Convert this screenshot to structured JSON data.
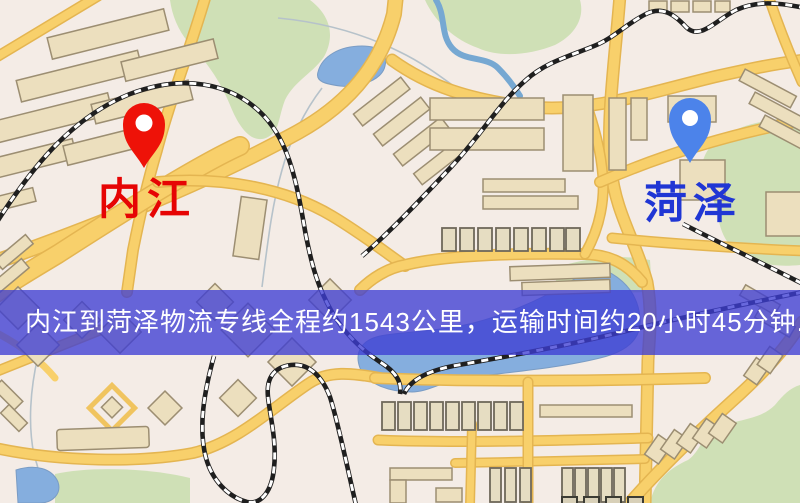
{
  "banner": {
    "text": "内江到菏泽物流专线全程约1543公里，运输时间约20小时45分钟.",
    "background": "#3e3ed4",
    "text_color": "#ffffff"
  },
  "markers": {
    "origin": {
      "label": "内江",
      "pin_color": "#ee1208",
      "label_color": "#e60404"
    },
    "destination": {
      "label": "菏泽",
      "pin_color": "#4c83ea",
      "label_color": "#2036d4"
    }
  },
  "map_colors": {
    "background": "#f4ece6",
    "road": "#f8d06b",
    "water": "#85aede",
    "park": "#cfe0b6",
    "building": "#ecdfbe",
    "railway": "#1f1f1f"
  }
}
